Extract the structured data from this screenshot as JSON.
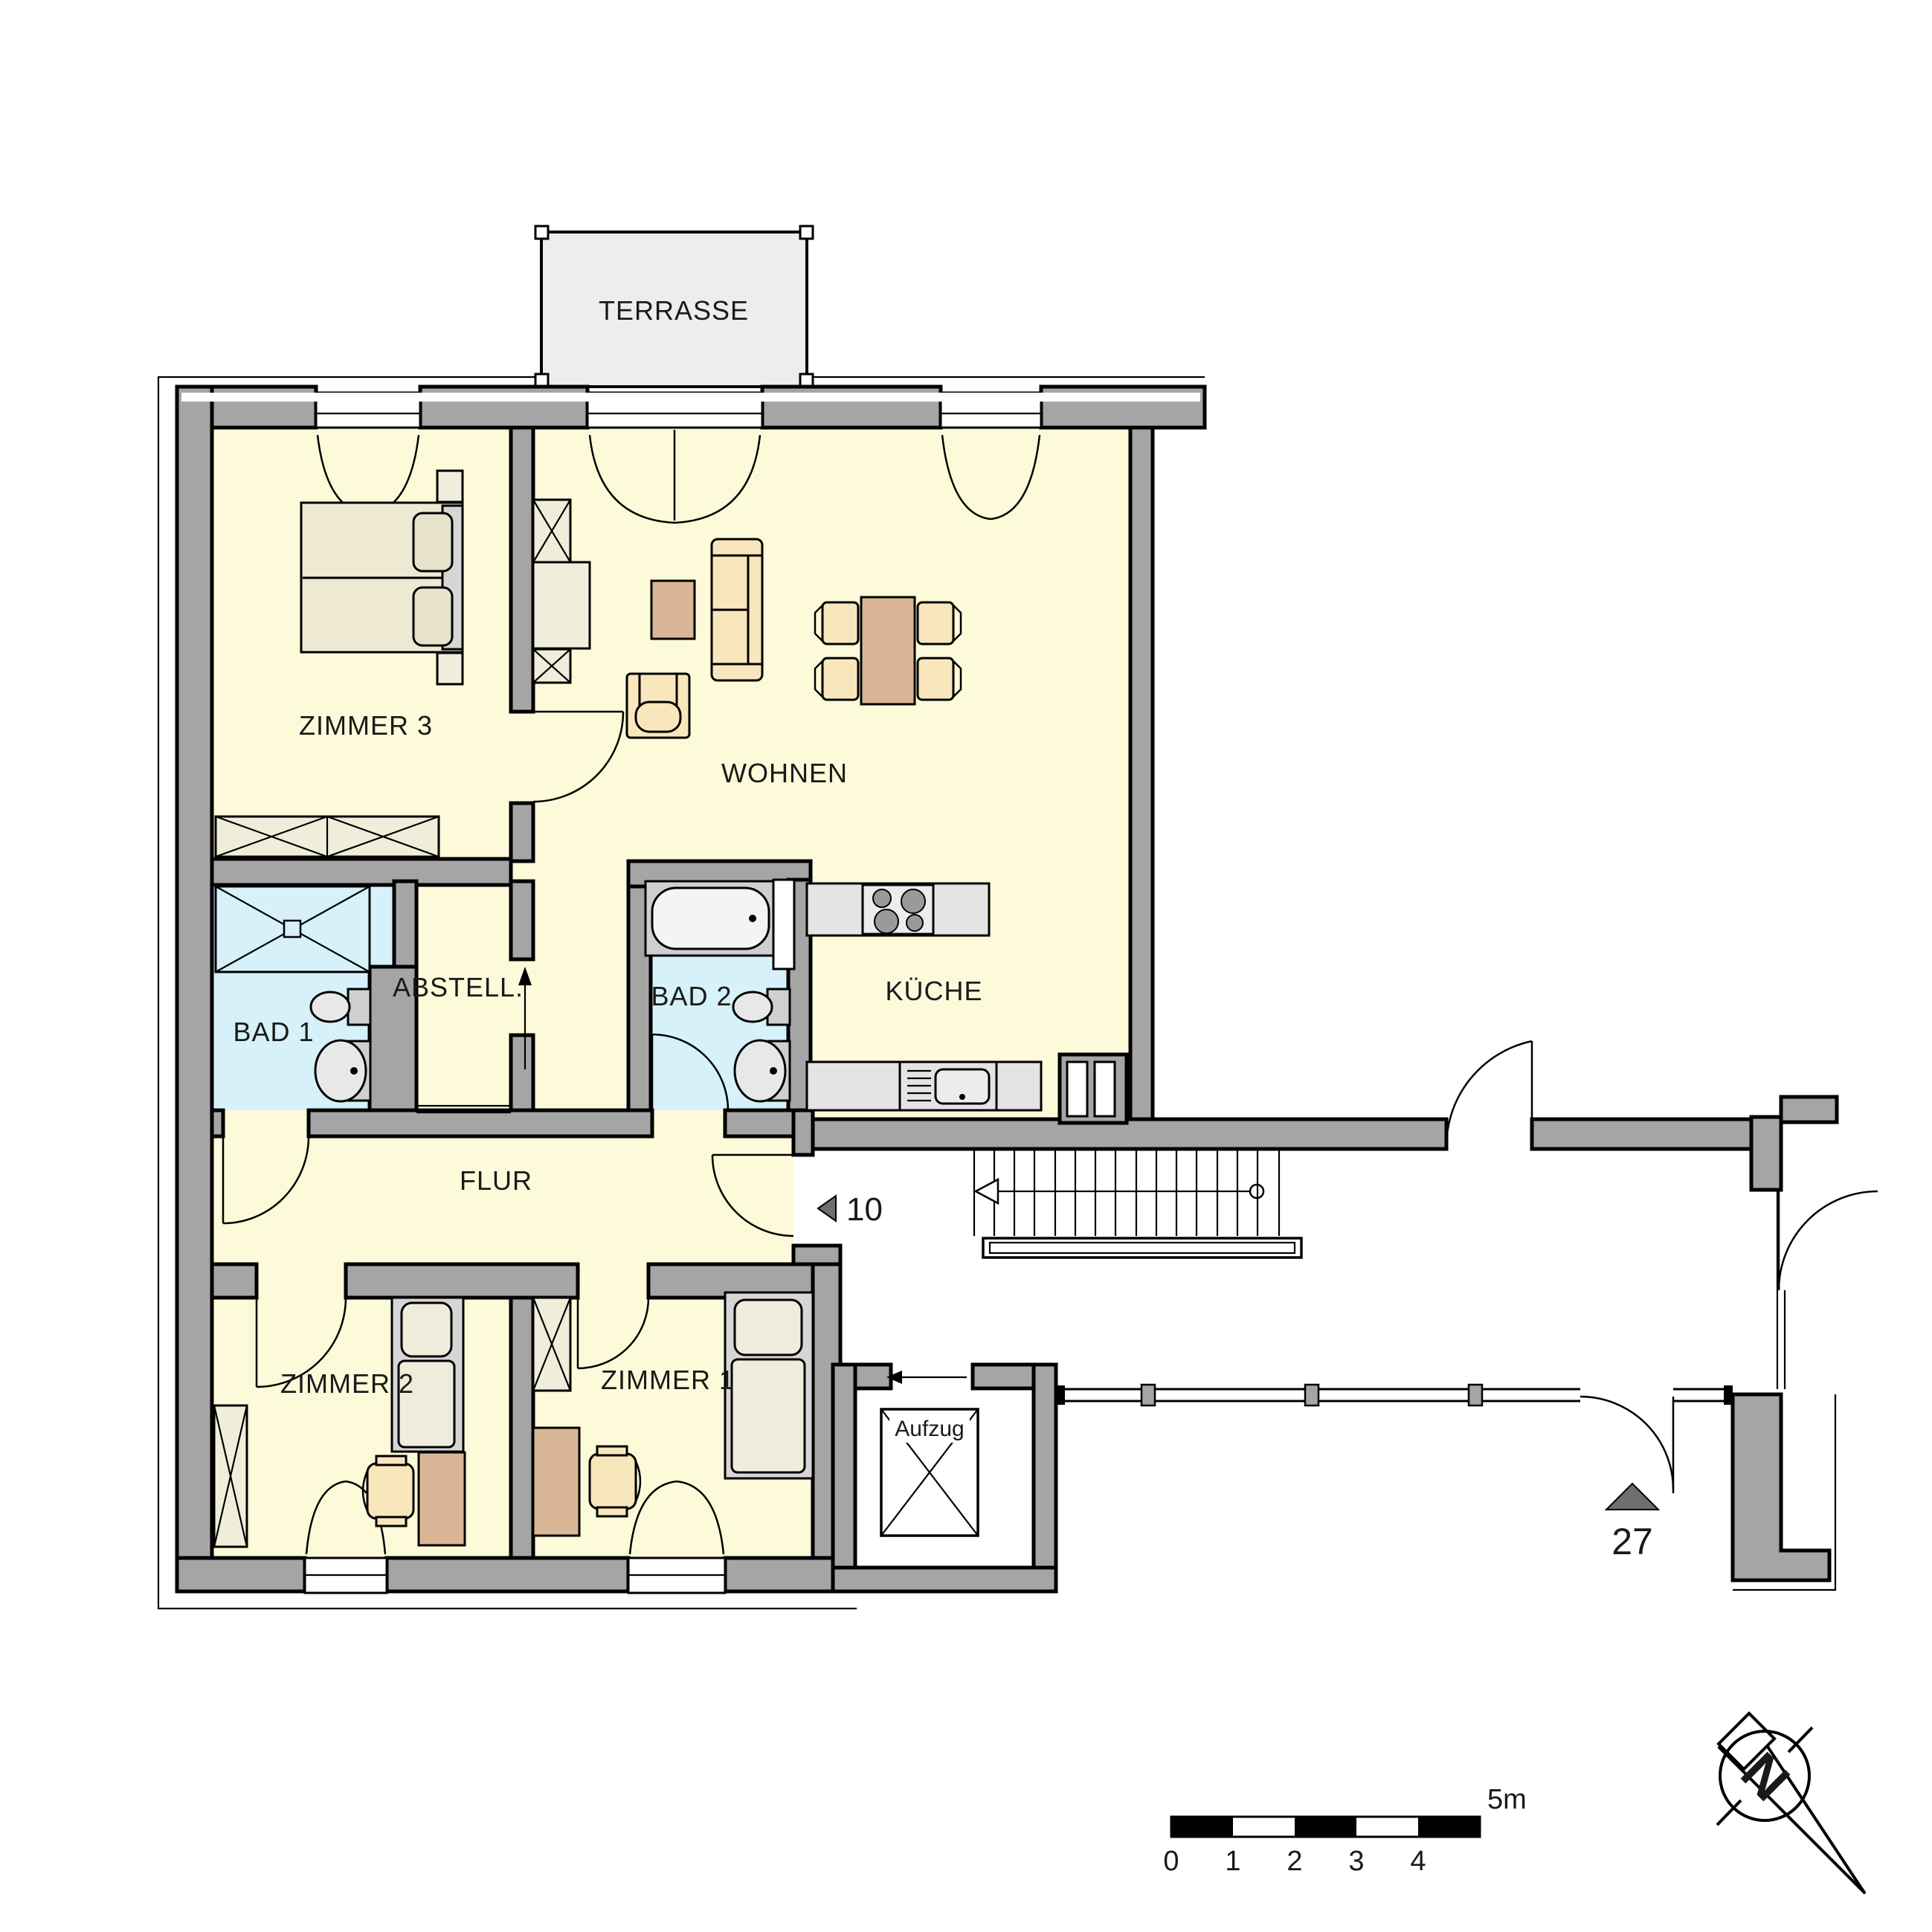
{
  "plan": {
    "rooms": {
      "terrasse": "TERRASSE",
      "zimmer3": "ZIMMER 3",
      "wohnen": "WOHNEN",
      "kueche": "KÜCHE",
      "bad1": "BAD 1",
      "bad2": "BAD 2",
      "abstell": "ABSTELL.",
      "flur": "FLUR",
      "zimmer2": "ZIMMER 2",
      "zimmer1": "ZIMMER 1",
      "aufzug": "Aufzug"
    },
    "markers": {
      "this_unit_number": "10",
      "neighbor_unit_number": "27"
    },
    "scale_bar": {
      "ticks": [
        "0",
        "1",
        "2",
        "3",
        "4"
      ],
      "end_label": "5m"
    },
    "colors": {
      "wall_gray": "#a5a5a5",
      "room_yellow": "#fcfad9",
      "bath_blue": "#d6f1f9",
      "terrace_gray": "#ededed",
      "counter_gray": "#e4e4e4",
      "furniture_tan": "#d9b796",
      "furniture_cream": "#f8e6bd",
      "mattress_cream": "#eee9d2",
      "frame_gray": "#d6d6d6"
    }
  }
}
